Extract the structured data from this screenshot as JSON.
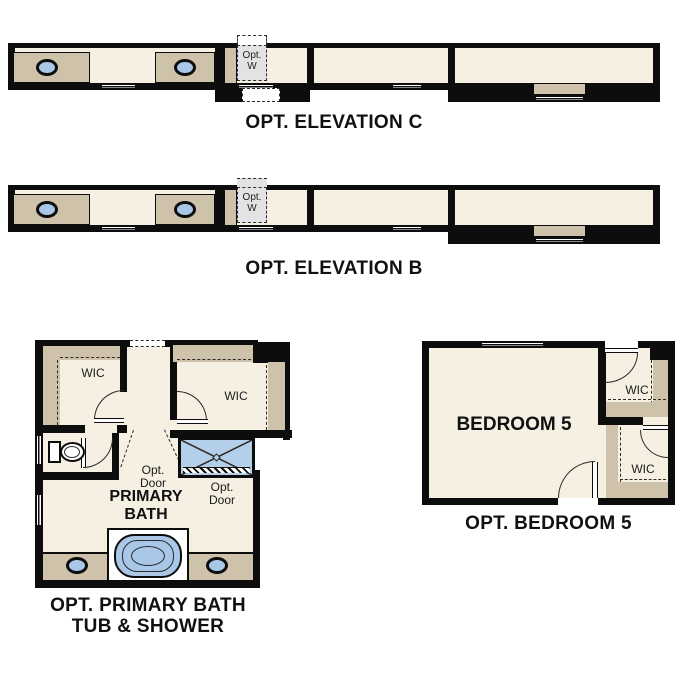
{
  "colors": {
    "wall": "#0d0d0d",
    "floor": "#f6f0e3",
    "tan": "#cec2aa",
    "blue": "#a9c7e6",
    "shower": "#b4cfea",
    "gray": "#e3e3e5",
    "line": "#2a2a2a"
  },
  "elevation_c": {
    "title": "OPT. ELEVATION C",
    "opt_w_line1": "Opt.",
    "opt_w_line2": "W"
  },
  "elevation_b": {
    "title": "OPT. ELEVATION B",
    "opt_w_line1": "Opt.",
    "opt_w_line2": "W"
  },
  "primary_bath": {
    "title_line1": "OPT. PRIMARY BATH",
    "title_line2": "TUB & SHOWER",
    "room_line1": "PRIMARY",
    "room_line2": "BATH",
    "wic_left": "WIC",
    "wic_right": "WIC",
    "opt_door1_line1": "Opt.",
    "opt_door1_line2": "Door",
    "opt_door2_line1": "Opt.",
    "opt_door2_line2": "Door"
  },
  "bedroom5": {
    "title": "OPT. BEDROOM 5",
    "room": "BEDROOM 5",
    "wic_top": "WIC",
    "wic_bottom": "WIC"
  }
}
